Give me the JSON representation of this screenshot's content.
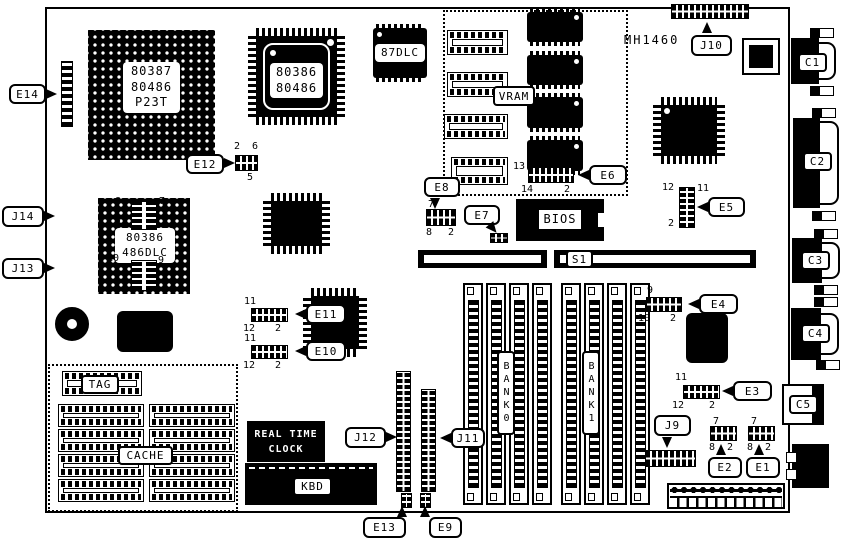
{
  "board": {
    "model": "MH1460"
  },
  "chips": {
    "pga_cpu": {
      "line1": "80387",
      "line2": "80486",
      "line3": "P23T"
    },
    "qfp_cpu": {
      "line1": "80386",
      "line2": "80486"
    },
    "fpu": {
      "label": "87DLC"
    },
    "dlc_cpu": {
      "line1": "80386",
      "line2": "486DLC"
    },
    "vram": {
      "label": "VRAM"
    },
    "bios": {
      "label": "BIOS"
    },
    "rtc": {
      "line1": "REAL TIME",
      "line2": "CLOCK"
    },
    "kbd": {
      "label": "KBD"
    },
    "tag": {
      "label": "TAG"
    },
    "cache": {
      "label": "CACHE"
    }
  },
  "memory": {
    "bank0": "BANK0",
    "bank1": "BANK1"
  },
  "slots": {
    "s1": "S1"
  },
  "ports": {
    "c1": "C1",
    "c2": "C2",
    "c3": "C3",
    "c4": "C4",
    "c5": "C5"
  },
  "callouts": {
    "e1": {
      "label": "E1",
      "pin_top": "7",
      "pin_bottom_left": "8",
      "pin_bottom_right": "2"
    },
    "e2": {
      "label": "E2",
      "pin_top": "7",
      "pin_bottom_left": "8",
      "pin_bottom_right": "2"
    },
    "e3": {
      "label": "E3",
      "pin_top": "11",
      "pin_bottom_left": "12",
      "pin_bottom_right": "2"
    },
    "e4": {
      "label": "E4",
      "pin_top": "9",
      "pin_bottom_left": "10",
      "pin_bottom_right": "2"
    },
    "e5": {
      "label": "E5",
      "pin_top_left": "12",
      "pin_top_right": "11",
      "pin_bottom": "2"
    },
    "e6": {
      "label": "E6",
      "pin_top": "13",
      "pin_bottom_left": "14",
      "pin_bottom_right": "2"
    },
    "e7": {
      "label": "E7"
    },
    "e8": {
      "label": "E8",
      "pin_top": "7",
      "pin_bottom_left": "8",
      "pin_bottom_right": "2"
    },
    "e9": {
      "label": "E9"
    },
    "e10": {
      "label": "E10",
      "pin_top": "11",
      "pin_bottom_left": "12",
      "pin_bottom_right": "2"
    },
    "e11": {
      "label": "E11",
      "pin_top": "11",
      "pin_bottom_left": "12",
      "pin_bottom_right": "2"
    },
    "e12": {
      "label": "E12",
      "pin_top_left": "2",
      "pin_top_right": "6",
      "pin_bottom": "5"
    },
    "e13": {
      "label": "E13"
    },
    "e14": {
      "label": "E14"
    },
    "j9": {
      "label": "J9"
    },
    "j10": {
      "label": "J10"
    },
    "j11": {
      "label": "J11"
    },
    "j12": {
      "label": "J12"
    },
    "j13": {
      "label": "J13",
      "pin_top_left": "10",
      "pin_top_right": "9",
      "pin_bottom": "2"
    },
    "j14": {
      "label": "J14",
      "pin_top_left": "8",
      "pin_top_right": "7",
      "pin_bottom": "2"
    }
  }
}
